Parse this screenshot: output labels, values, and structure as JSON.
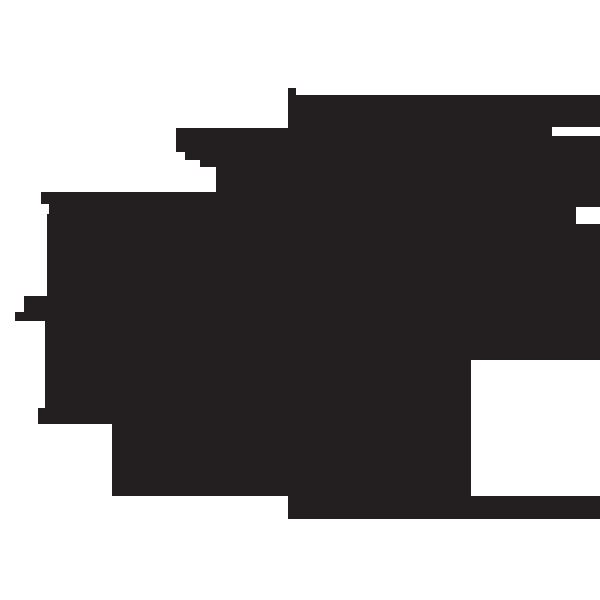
{
  "scene": {
    "description": "Abstract solid black silhouette with stepped axis-aligned edges on a plain white background",
    "background_color": "#ffffff",
    "canvas": {
      "width": 600,
      "height": 600
    },
    "shape": {
      "name": "black-stepped-blob",
      "fill_color": "#231f20",
      "points": [
        [
          288,
          88
        ],
        [
          296,
          88
        ],
        [
          296,
          95
        ],
        [
          600,
          95
        ],
        [
          600,
          127
        ],
        [
          552,
          127
        ],
        [
          552,
          136
        ],
        [
          600,
          136
        ],
        [
          600,
          207
        ],
        [
          576,
          207
        ],
        [
          576,
          224
        ],
        [
          600,
          224
        ],
        [
          600,
          360
        ],
        [
          471,
          360
        ],
        [
          471,
          496
        ],
        [
          600,
          496
        ],
        [
          600,
          519
        ],
        [
          288,
          519
        ],
        [
          288,
          496
        ],
        [
          112,
          496
        ],
        [
          112,
          424
        ],
        [
          38,
          424
        ],
        [
          38,
          408
        ],
        [
          45,
          408
        ],
        [
          45,
          321
        ],
        [
          15,
          321
        ],
        [
          15,
          312
        ],
        [
          24,
          312
        ],
        [
          24,
          296
        ],
        [
          47,
          296
        ],
        [
          47,
          214
        ],
        [
          49,
          214
        ],
        [
          49,
          204
        ],
        [
          41,
          204
        ],
        [
          41,
          192
        ],
        [
          216,
          192
        ],
        [
          216,
          167
        ],
        [
          200,
          167
        ],
        [
          200,
          160
        ],
        [
          185,
          160
        ],
        [
          185,
          152
        ],
        [
          176,
          152
        ],
        [
          176,
          128
        ],
        [
          288,
          128
        ]
      ]
    }
  }
}
